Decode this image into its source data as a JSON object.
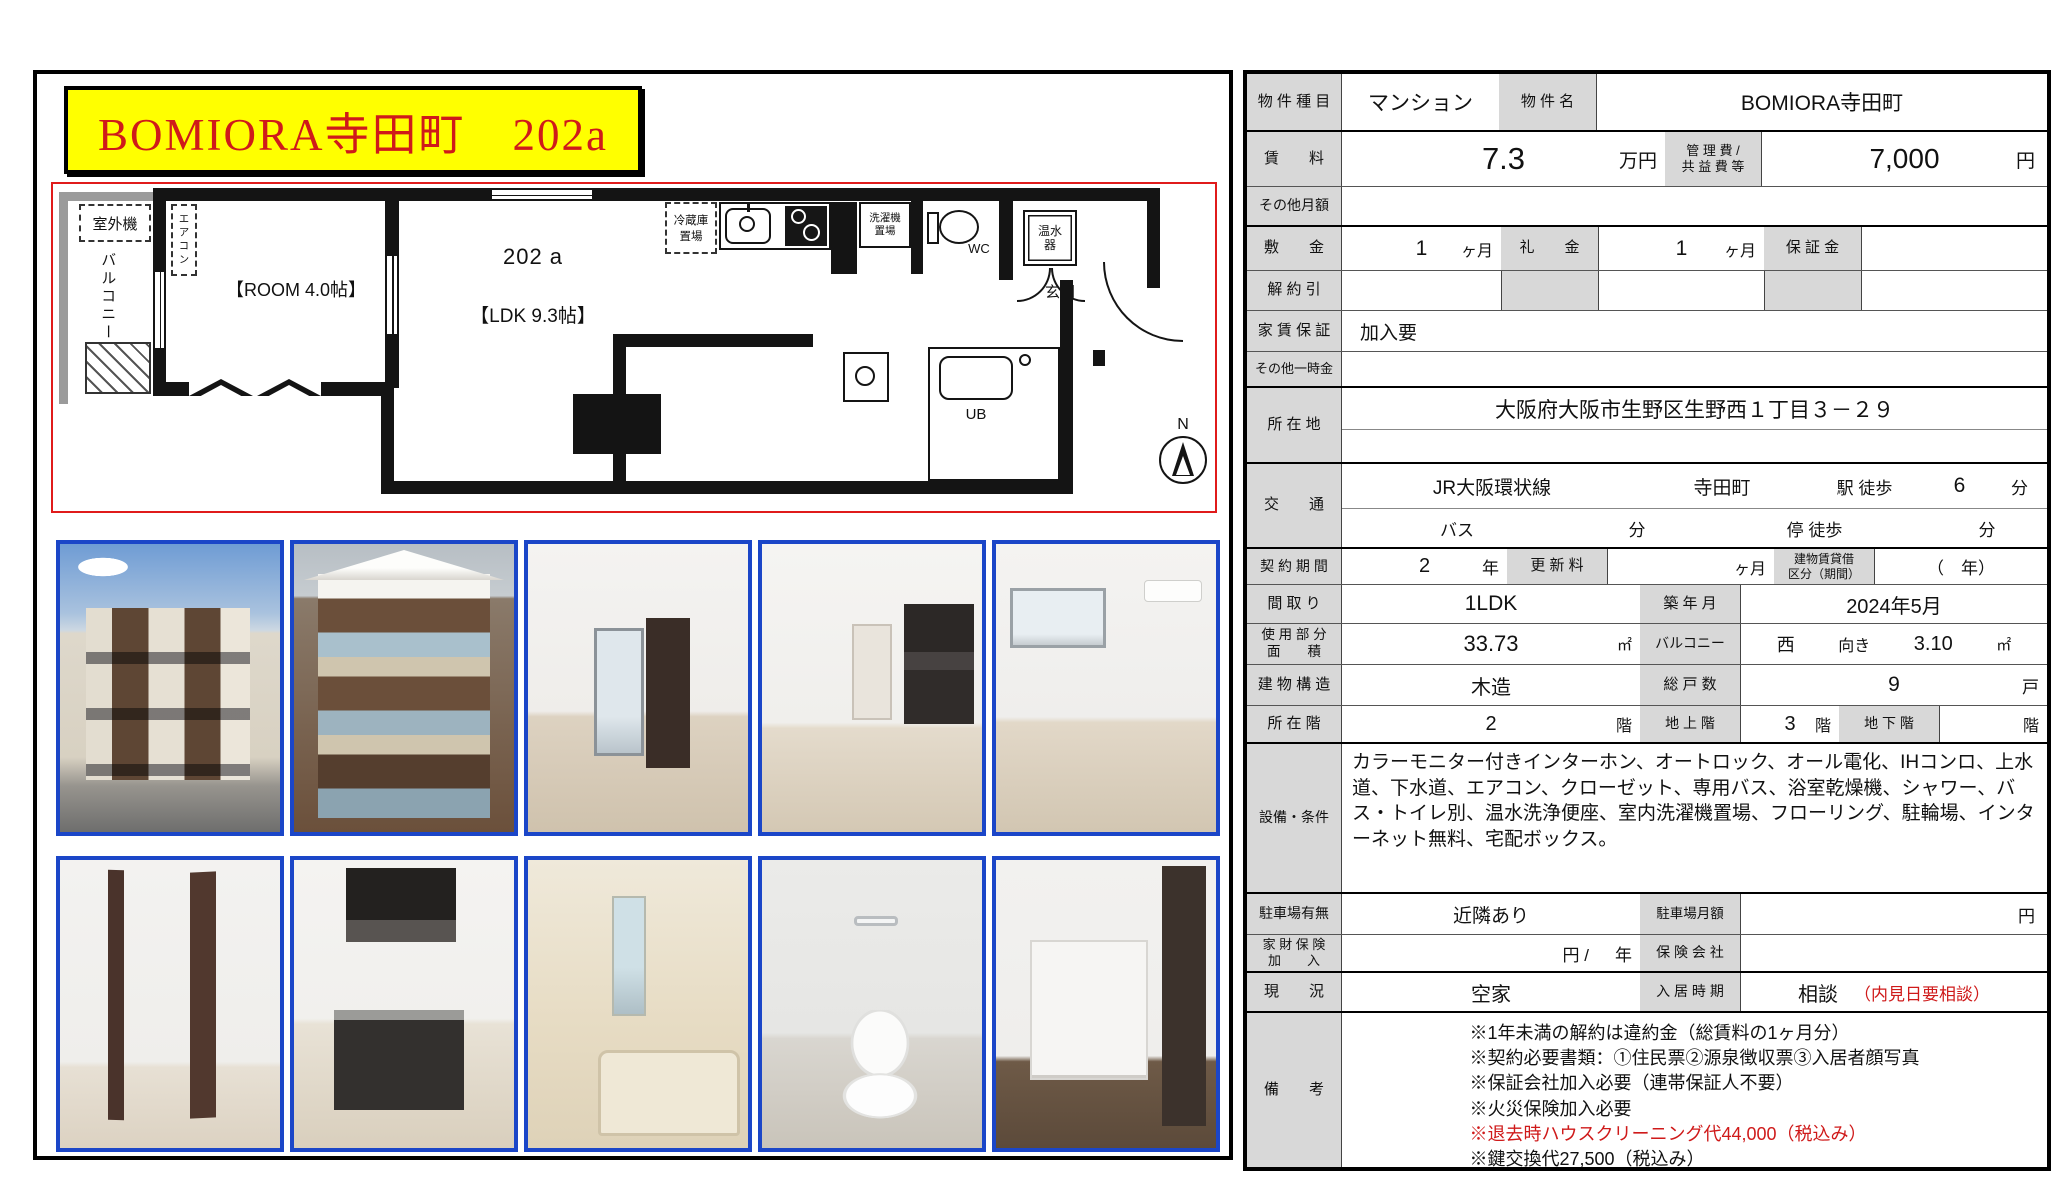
{
  "colors": {
    "title_bg": "#ffff00",
    "title_text": "#cf1a1a",
    "photo_border": "#1b46c8",
    "plan_border": "#e01b1b",
    "label_bg": "#d8d8d8",
    "remark_red": "#cf1a1a"
  },
  "title": "BOMIORA寺田町　202a",
  "floorplan": {
    "outdoor_unit": "室外機",
    "balcony": "バルコニー",
    "aircon": "エアコン",
    "room": "【ROOM 4.0帖】",
    "unit_number": "202 a",
    "ldk": "【LDK 9.3帖】",
    "fridge": "冷蔵庫\n置場",
    "washer": "洗濯機\n置場",
    "wc": "WC",
    "water_heater": "温水\n器",
    "entrance": "玄関",
    "washroom": "洗面室",
    "unit_bath": "UB",
    "north": "N"
  },
  "photo_names": {
    "row1": [
      "exterior-angled-view",
      "exterior-front-view",
      "interior-hallway",
      "interior-ldk",
      "interior-room-window"
    ],
    "row2": [
      "closet-open-doors",
      "kitchen-unit",
      "unit-bath",
      "toilet",
      "entrance-storage"
    ]
  },
  "table": {
    "property_type_label": "物 件 種 目",
    "property_type": "マンション",
    "property_name_label": "物 件 名",
    "property_name": "BOMIORA寺田町",
    "rent_label": "賃　　料",
    "rent": "7.3",
    "rent_unit": "万円",
    "mgmt_label1": "管 理 費 /",
    "mgmt_label2": "共 益 費 等",
    "mgmt_fee": "7,000",
    "mgmt_unit": "円",
    "other_monthly_label": "その他月額",
    "deposit_label": "敷　　金",
    "deposit": "1",
    "deposit_unit": "ヶ月",
    "key_money_label": "礼　　金",
    "key_money": "1",
    "key_money_unit": "ヶ月",
    "guarantee_label": "保 証 金",
    "cancel_label": "解 約 引",
    "rent_guarantee_label": "家 賃 保 証",
    "rent_guarantee": "加入要",
    "other_onetime_label": "その他一時金",
    "address_label": "所 在 地",
    "address": "大阪府大阪市生野区生野西１丁目３－２９",
    "transport_label": "交　　通",
    "line_name": "JR大阪環状線",
    "station": "寺田町",
    "station_suffix": "駅 徒歩",
    "walk_min": "6",
    "walk_min_unit": "分",
    "bus_label": "バス",
    "bus_min_unit": "分",
    "stop_suffix": "停 徒歩",
    "stop_min_unit": "分",
    "contract_label": "契 約 期 間",
    "contract_years": "2",
    "contract_unit": "年",
    "renewal_label": "更 新 料",
    "renewal_unit": "ヶ月",
    "lease_type_label1": "建物賃貸借",
    "lease_type_label2": "区分（期間）",
    "lease_type_value": "（　年）",
    "layout_label": "間 取 り",
    "layout": "1LDK",
    "built_label": "築 年 月",
    "built": "2024年5月",
    "area_label1": "使 用 部 分",
    "area_label2": "面　　積",
    "area": "33.73",
    "area_unit": "㎡",
    "balcony_label": "バルコニー",
    "balcony_direction": "西",
    "balcony_facing": "向き",
    "balcony_area": "3.10",
    "balcony_unit": "㎡",
    "structure_label": "建 物 構 造",
    "structure": "木造",
    "units_label": "総 戸 数",
    "units": "9",
    "units_unit": "戸",
    "floor_label": "所 在 階",
    "floor": "2",
    "floor_unit": "階",
    "above_ground_label": "地 上 階",
    "above_ground": "3",
    "above_ground_unit": "階",
    "below_ground_label": "地 下 階",
    "below_ground_unit": "階",
    "equipment_label": "設備・条件",
    "equipment": "カラーモニター付きインターホン、オートロック、オール電化、IHコンロ、上水道、下水道、エアコン、クローゼット、専用バス、浴室乾燥機、シャワー、バス・トイレ別、温水洗浄便座、室内洗濯機置場、フローリング、駐輪場、インターネット無料、宅配ボックス。",
    "parking_label": "駐車場有無",
    "parking": "近隣あり",
    "parking_fee_label": "駐車場月額",
    "parking_fee_unit": "円",
    "insurance_label1": "家 財 保 険",
    "insurance_label2": "加　　入",
    "insurance_unit": "円 /",
    "insurance_year_unit": "年",
    "insurer_label": "保 険 会 社",
    "status_label": "現　　況",
    "status": "空家",
    "movein_label": "入 居 時 期",
    "movein": "相談",
    "movein_note": "（内見日要相談）",
    "remarks_label": "備　　考",
    "remarks": [
      "※1年未満の解約は違約金（総賃料の1ヶ月分）",
      "※契約必要書類：①住民票②源泉徴収票③入居者顔写真",
      "※保証会社加入必要（連帯保証人不要）",
      "※火災保険加入必要",
      "※退去時ハウスクリーニング代44,000（税込み）",
      "※鍵交換代27,500（税込み）"
    ]
  }
}
